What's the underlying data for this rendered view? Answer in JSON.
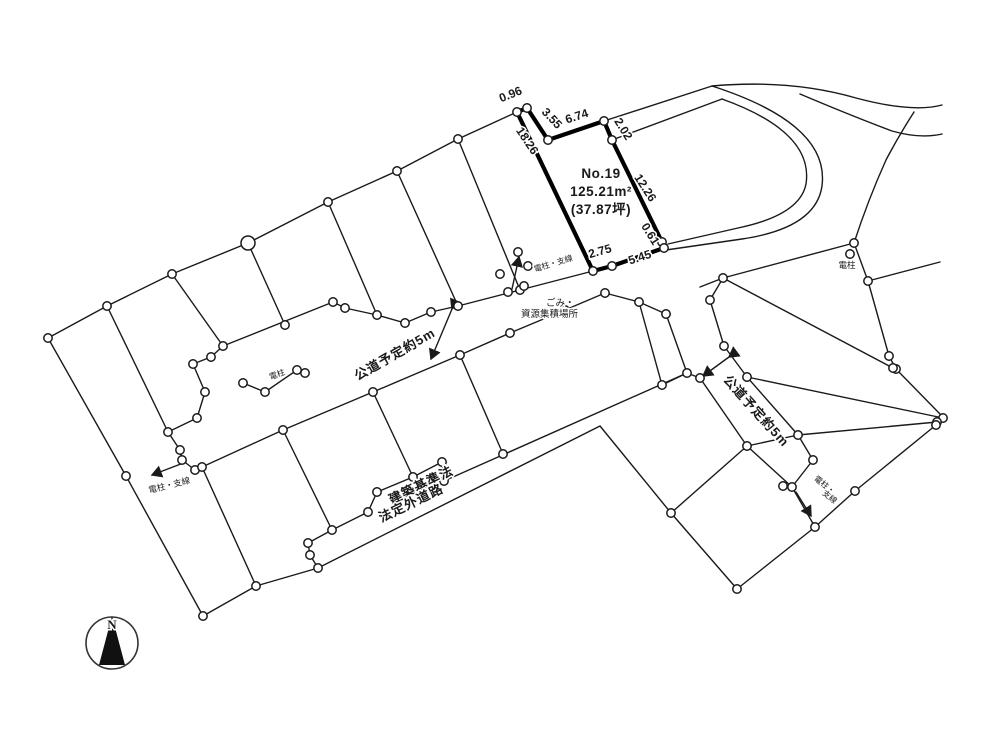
{
  "parcel": {
    "no": "No.19",
    "area_sqm": "125.21m²",
    "area_tsubo": "(37.87坪)"
  },
  "dimensions": {
    "d_096": "0.96",
    "d_355": "3.55",
    "d_674": "6.74",
    "d_202": "2.02",
    "d_1826": "18.26",
    "d_1226": "12.26",
    "d_061": "0.61",
    "d_545": "5.45",
    "d_275": "2.75"
  },
  "roads": {
    "left_planned_road": "公道予定約5m",
    "right_planned_road": "公道予定約5m",
    "offlaw_road_line1": "建築基準法",
    "offlaw_road_line2": "法定外道路"
  },
  "utilities": {
    "pole_left": "電柱",
    "pole_right": "電柱",
    "pole_wire_left": "電柱・支線",
    "pole_wire_center": "電柱・支線",
    "pole_wire_right_line1": "電柱・",
    "pole_wire_right_line2": "支線"
  },
  "facilities": {
    "garbage_line1": "ごみ・",
    "garbage_line2": "資源集積場所"
  },
  "compass": {
    "north": "N"
  },
  "colors": {
    "line": "#1a1a1a",
    "background": "#ffffff"
  }
}
